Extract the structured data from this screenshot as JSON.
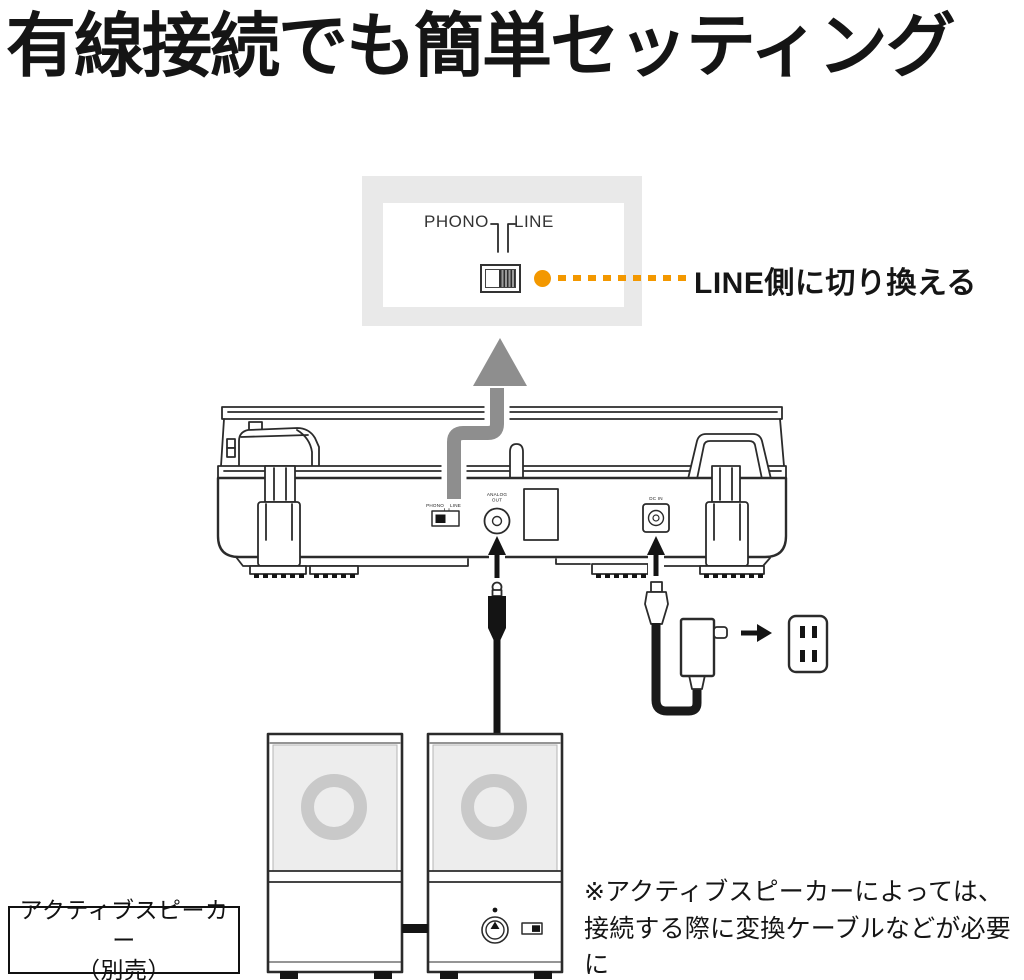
{
  "title": "有線接続でも簡単セッティング",
  "callout": {
    "phono_label": "PHONO",
    "line_label": "LINE",
    "annotation": "LINE側に切り換える"
  },
  "turntable": {
    "phono_label": "PHONO",
    "line_label": "LINE",
    "analog_out_line1": "ANALOG",
    "analog_out_line2": "OUT",
    "dc_in_label": "DC IN"
  },
  "speaker_label": {
    "line1": "アクティブスピーカー",
    "line2": "（別売）"
  },
  "note": {
    "line1": "※アクティブスピーカーによっては、",
    "line2": "接続する際に変換ケーブルなどが必要に",
    "line3": "なる場合があります。"
  },
  "colors": {
    "accent_orange": "#F39800",
    "arrow_gray": "#8E8E8E",
    "callout_bg": "#E9E9E9",
    "speaker_panel": "#EDEDED",
    "speaker_ring": "#C9C9C9",
    "line_art": "#2B2B2B"
  }
}
